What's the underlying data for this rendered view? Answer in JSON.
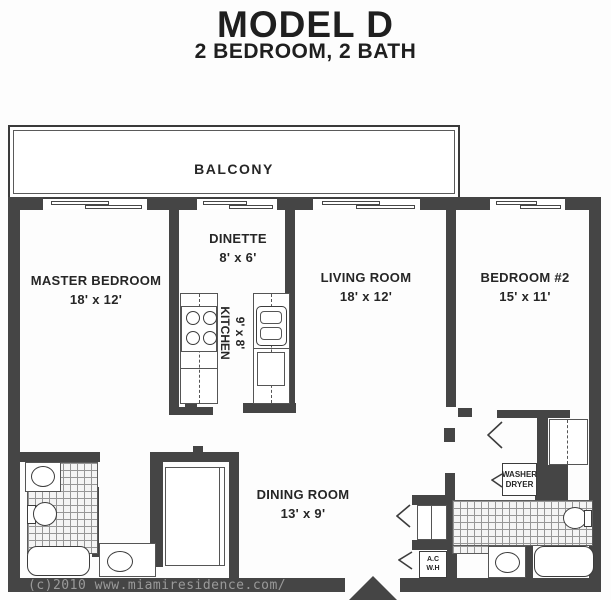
{
  "title": {
    "line1": "MODEL D",
    "line2": "2 BEDROOM, 2 BATH"
  },
  "rooms": {
    "balcony": {
      "label": "BALCONY"
    },
    "master_bedroom": {
      "label": "MASTER BEDROOM",
      "dims": "18' x 12'"
    },
    "dinette": {
      "label": "DINETTE",
      "dims": "8' x 6'"
    },
    "kitchen": {
      "label": "KITCHEN",
      "dims": "9' x 8'"
    },
    "living_room": {
      "label": "LIVING ROOM",
      "dims": "18' x 12'"
    },
    "bedroom_2": {
      "label": "BEDROOM #2",
      "dims": "15' x 11'"
    },
    "dining_room": {
      "label": "DINING ROOM",
      "dims": "13' x 9'"
    }
  },
  "fixtures": {
    "washer_dryer": {
      "line1": "WASHER",
      "line2": "DRYER"
    },
    "ac_water_heater": {
      "line1": "A.C",
      "line2": "W.H"
    }
  },
  "watermark": "(c)2010 www.miamiresidence.com/",
  "colors": {
    "wall": "#454545",
    "ink": "#262626",
    "tile_line": "#969696",
    "watermark_text": "#9a9a9a"
  }
}
